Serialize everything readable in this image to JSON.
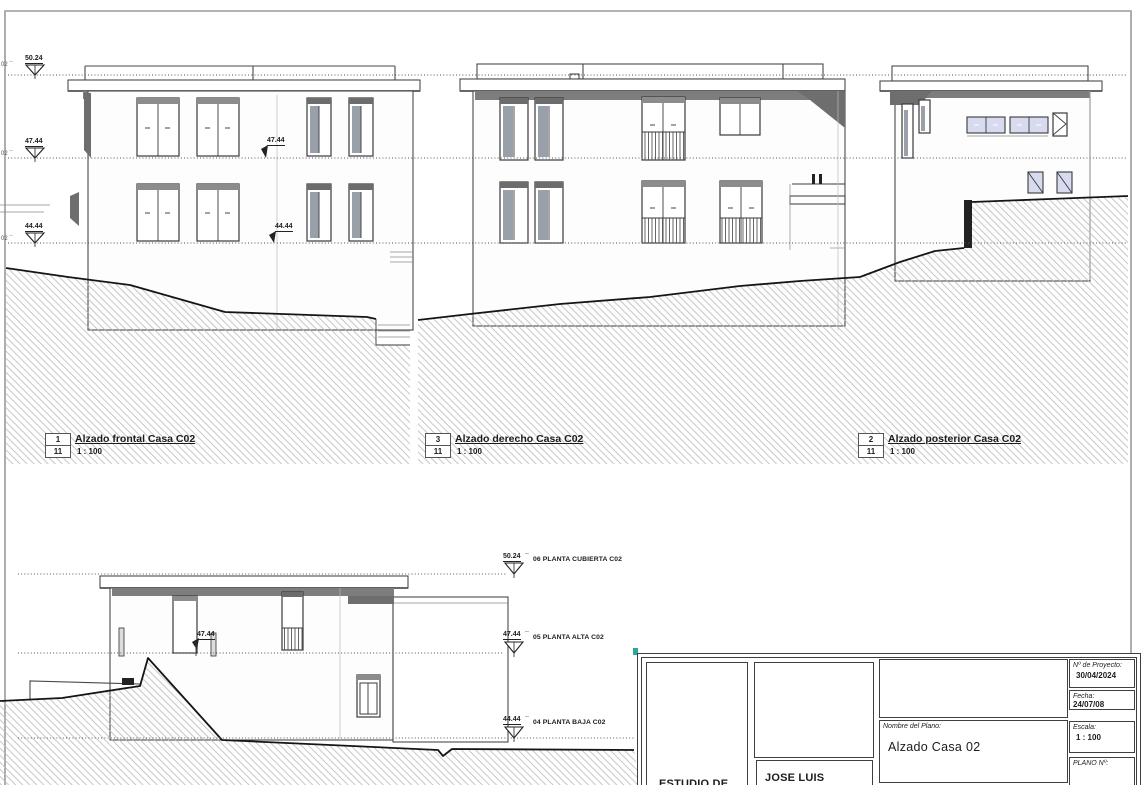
{
  "drawing": {
    "edge_label": "02 ¯",
    "tick": "¯",
    "levels": {
      "cubierta": {
        "value": "50.24",
        "name": "06 PLANTA CUBIERTA C02"
      },
      "alta": {
        "value": "47.44",
        "name": "05 PLANTA ALTA C02"
      },
      "baja": {
        "value": "44.44",
        "name": "04 PLANTA BAJA C02"
      }
    },
    "spots": {
      "frontal_alta": "47.44",
      "frontal_baja": "44.44",
      "bottom_alta": "47.44"
    },
    "views": {
      "frontal": {
        "number": "1",
        "sheet": "11",
        "title": "Alzado frontal Casa C02",
        "scale": "1 : 100"
      },
      "derecho": {
        "number": "3",
        "sheet": "11",
        "title": "Alzado derecho Casa C02",
        "scale": "1 : 100"
      },
      "posterior": {
        "number": "2",
        "sheet": "11",
        "title": "Alzado posterior Casa C02",
        "scale": "1 : 100"
      }
    }
  },
  "titleblock": {
    "studio": "ESTUDIO DE",
    "architect": "JOSE LUIS",
    "name_label": "Nombre del Plano:",
    "name_value": "Alzado Casa 02",
    "project_label": "Nº de Proyecto:",
    "project_value": "30/04/2024",
    "date_label": "Fecha:",
    "date_value": "24/07/08",
    "scale_label": "Escala:",
    "scale_value": "1 : 100",
    "plan_label": "PLANO Nº:"
  },
  "colors": {
    "line": "#3a3a3a",
    "hatch": "#b9b9b9",
    "eaves": "#7d7d7d",
    "glass": "#d8daef",
    "teal": "#2aa89e"
  }
}
